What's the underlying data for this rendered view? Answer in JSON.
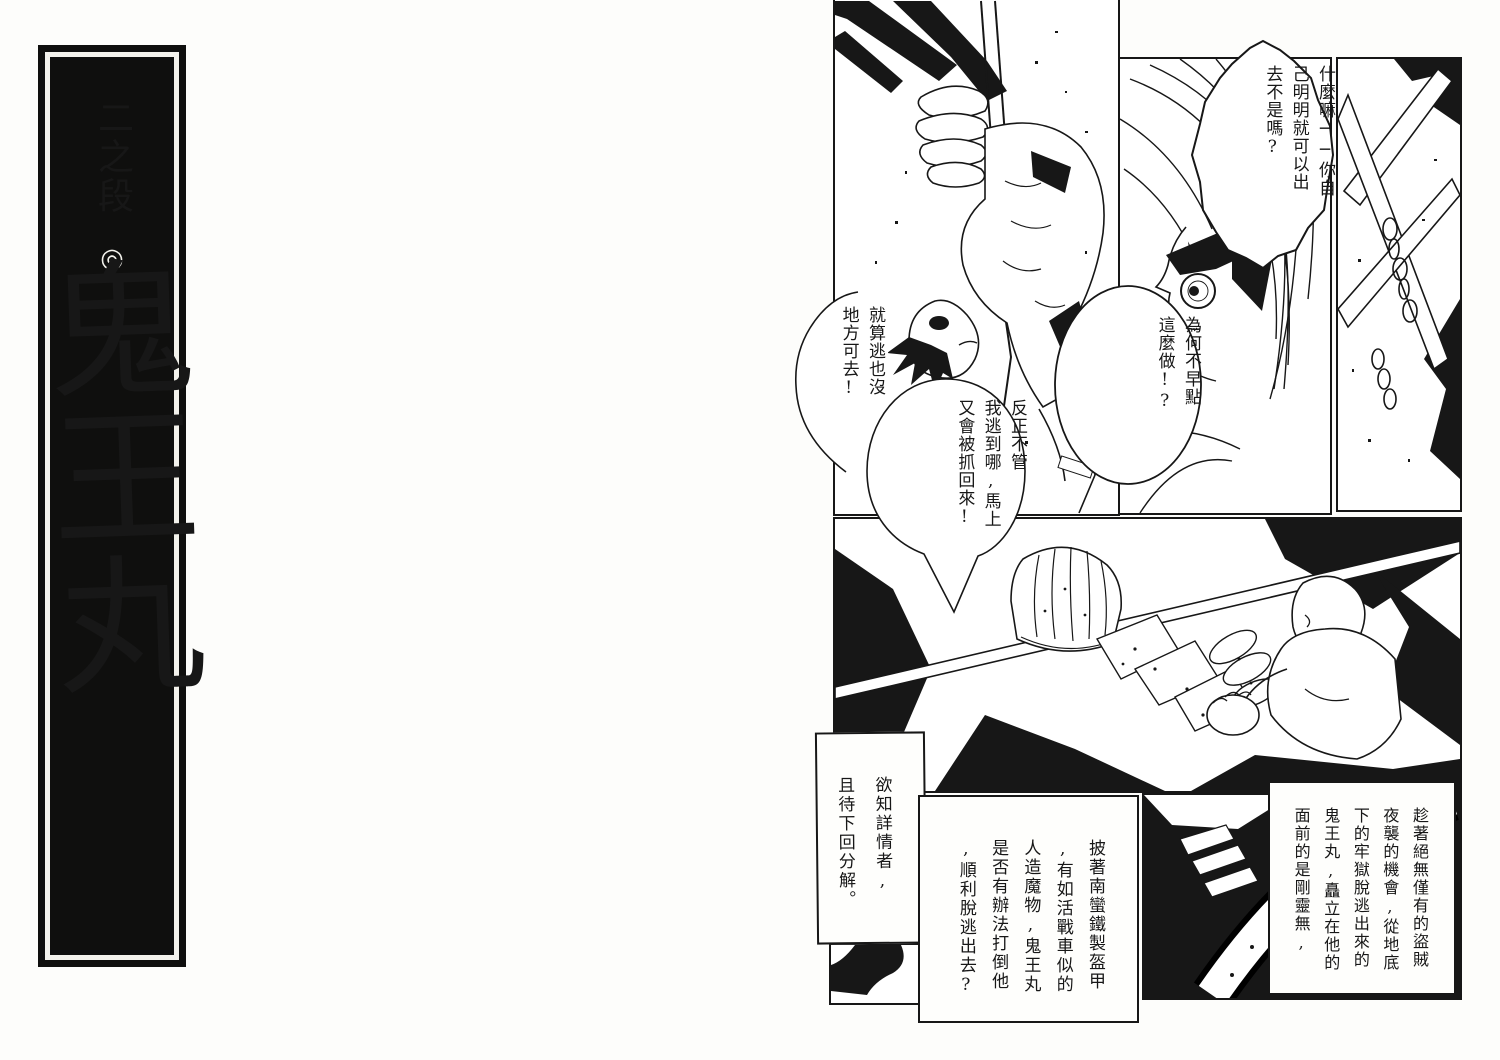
{
  "page": {
    "paper_color": "#fdfdfb",
    "ink_color": "#171717"
  },
  "chapter_banner": {
    "header": "二之段",
    "mark": "◎",
    "title": "鬼王丸",
    "background": "#0f0f0e",
    "foreground": "#f3f2ec"
  },
  "speech_bubbles": [
    {
      "id": "bubble-what",
      "text": "什麼嘛──你自\n己明明就可以出\n去不是嗎?"
    },
    {
      "id": "bubble-why",
      "text": "為何不早點\n這麼做!?"
    },
    {
      "id": "bubble-nowhere",
      "text": "就算逃也沒\n地方可去!"
    },
    {
      "id": "bubble-caught",
      "text": "反正不管\n我逃到哪,馬上\n又會被抓回來!"
    }
  ],
  "caption_boxes": [
    {
      "id": "box-next",
      "text": "欲知詳情者,\n且待下回分解。"
    },
    {
      "id": "box-mid",
      "text": "披著南蠻鐵製盔甲\n,有如活戰車似的\n人造魔物,鬼王丸\n是否有辦法打倒他\n,順利脫逃出去?"
    },
    {
      "id": "box-right",
      "text": "趁著絕無僅有的盜賊\n夜襲的機會,從地底\n下的牢獄脫逃出來的\n鬼王丸,矗立在他的\n面前的是剛靈無,"
    }
  ]
}
